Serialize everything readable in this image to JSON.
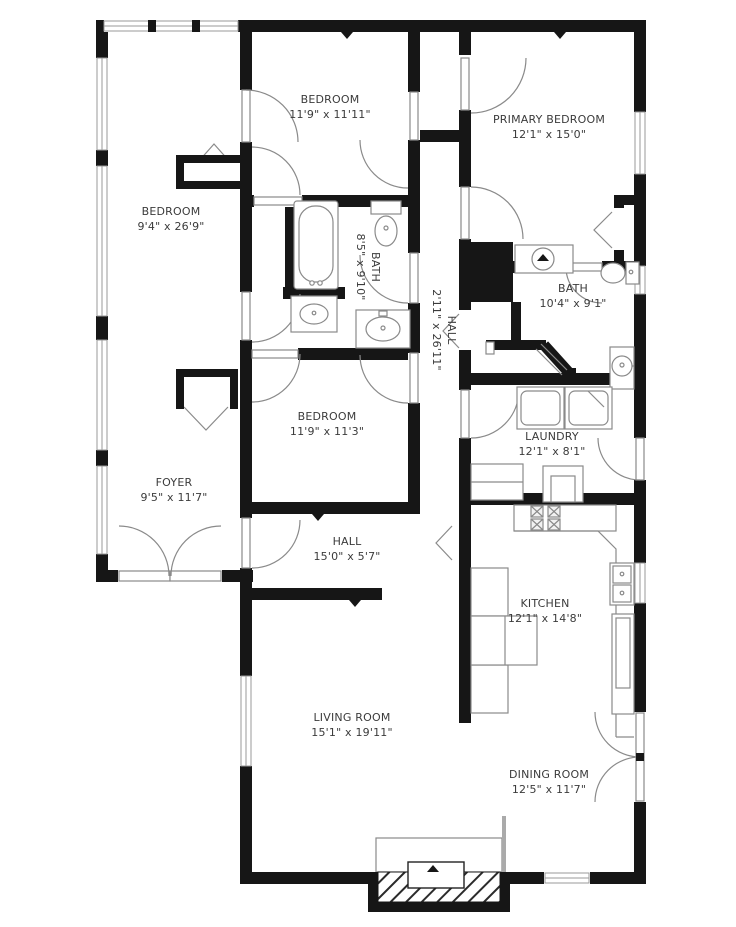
{
  "floorplan": {
    "type": "residential-floor-plan",
    "colors": {
      "wall": "#161616",
      "fixture_line": "#8a8a8a",
      "background": "#ffffff",
      "text": "#3b3b3b"
    },
    "rooms": [
      {
        "name": "BEDROOM",
        "dims": "9'4\" x 26'9\""
      },
      {
        "name": "BEDROOM",
        "dims": "11'9\" x 11'11\""
      },
      {
        "name": "PRIMARY BEDROOM",
        "dims": "12'1\" x 15'0\""
      },
      {
        "name": "BATH",
        "dims": "8'5\" x 9'10\""
      },
      {
        "name": "HALL",
        "dims": "2'11\" x 26'11\""
      },
      {
        "name": "BATH",
        "dims": "10'4\" x 9'1\""
      },
      {
        "name": "BEDROOM",
        "dims": "11'9\" x 11'3\""
      },
      {
        "name": "LAUNDRY",
        "dims": "12'1\" x 8'1\""
      },
      {
        "name": "FOYER",
        "dims": "9'5\" x 11'7\""
      },
      {
        "name": "HALL",
        "dims": "15'0\" x 5'7\""
      },
      {
        "name": "KITCHEN",
        "dims": "12'1\" x 14'8\""
      },
      {
        "name": "LIVING ROOM",
        "dims": "15'1\" x 19'11\""
      },
      {
        "name": "DINING ROOM",
        "dims": "12'5\" x 11'7\""
      }
    ]
  }
}
